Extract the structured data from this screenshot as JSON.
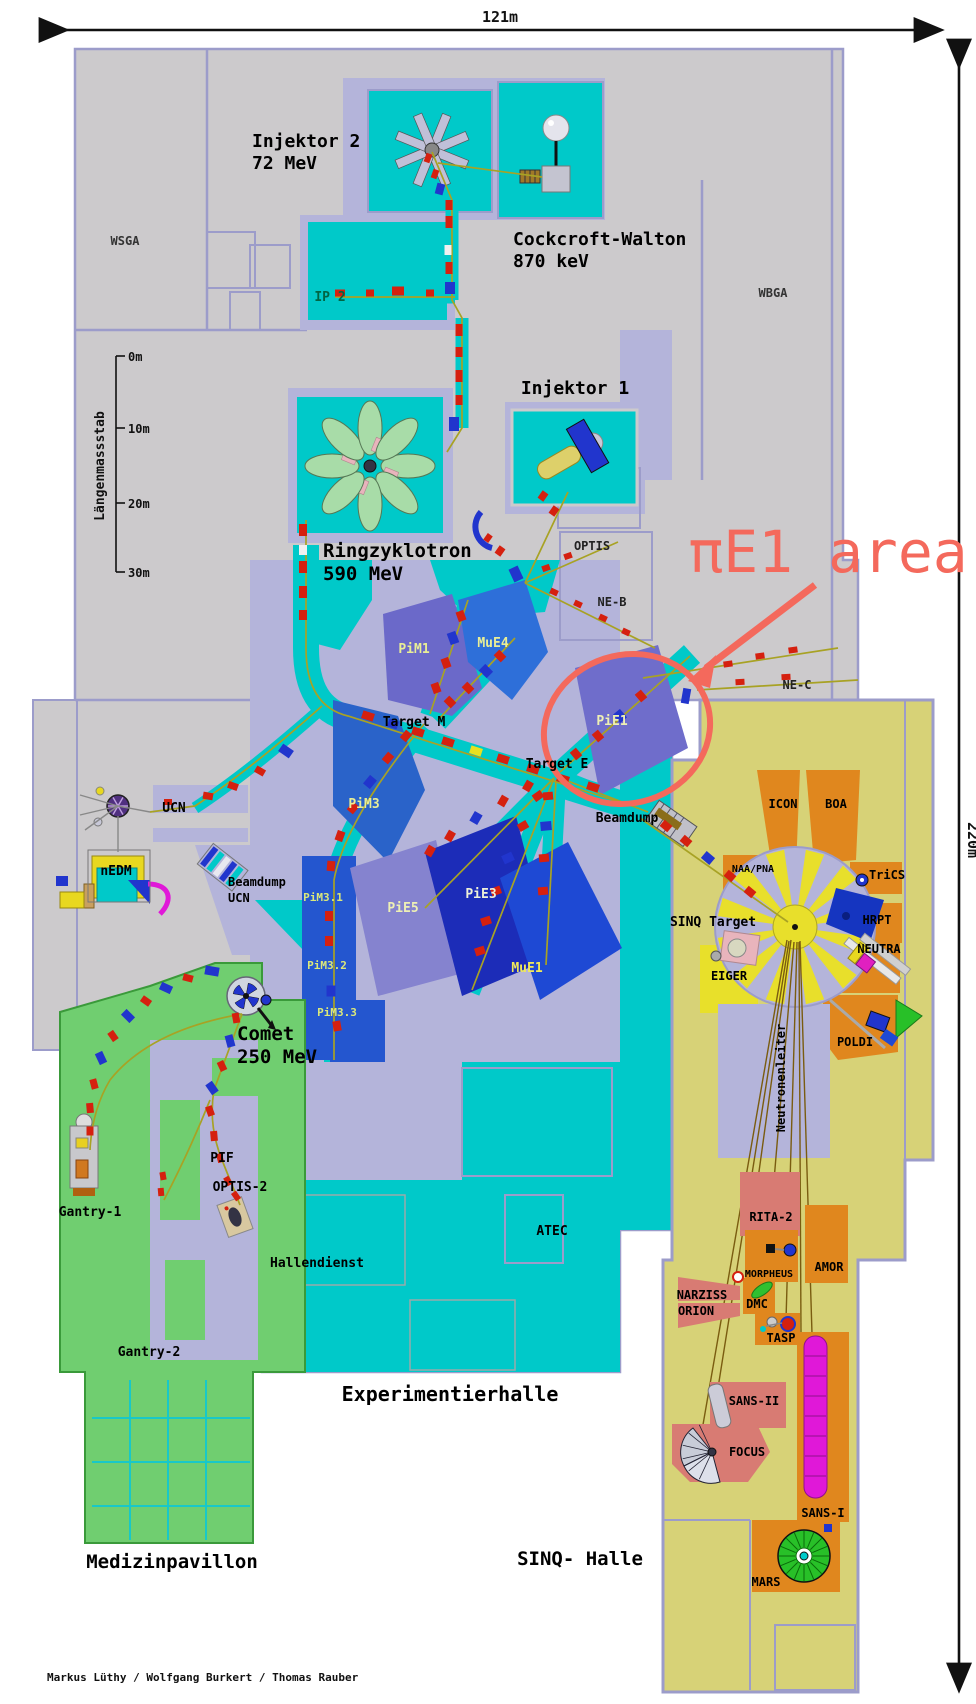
{
  "annotation": {
    "pie1_area_label": "πE1 area"
  },
  "dimensions": {
    "width_label": "121m",
    "height_label": "220m"
  },
  "scalebar": {
    "title": "Längenmassstab",
    "ticks": [
      "0m",
      "10m",
      "20m",
      "30m"
    ]
  },
  "labels": {
    "injektor2_1": "Injektor 2",
    "injektor2_2": "72 MeV",
    "cockcroft_1": "Cockcroft-Walton",
    "cockcroft_2": "870 keV",
    "wsga": "WSGA",
    "wbga": "WBGA",
    "ip2": "IP 2",
    "injektor1": "Injektor 1",
    "ring_1": "Ringzyklotron",
    "ring_2": "590 MeV",
    "optis": "OPTIS",
    "neb": "NE-B",
    "nec": "NE-C",
    "pim1": "PiM1",
    "mue4": "MuE4",
    "pie1": "PiE1",
    "target_m": "Target M",
    "target_e": "Target E",
    "beamdump": "Beamdump",
    "ucn": "UCN",
    "nedm": "nEDM",
    "bd_ucn1": "Beamdump",
    "bd_ucn2": "UCN",
    "pim3": "PiM3",
    "pim3_1": "PiM3.1",
    "pim3_2": "PiM3.2",
    "pim3_3": "PiM3.3",
    "pie5": "PiE5",
    "pie3": "PiE3",
    "mue1": "MuE1",
    "comet_1": "Comet",
    "comet_2": "250 MeV",
    "pif": "PIF",
    "optis2": "OPTIS-2",
    "gantry1": "Gantry-1",
    "gantry2": "Gantry-2",
    "hallendienst": "Hallendienst",
    "atec": "ATEC",
    "experimentierhalle": "Experimentierhalle",
    "medizinpavillon": "Medizinpavillon",
    "sinq_halle": "SINQ- Halle",
    "sinq_target": "SINQ Target",
    "icon": "ICON",
    "boa": "BOA",
    "naapna": "NAA/PNA",
    "trics": "TriCS",
    "hrpt": "HRPT",
    "neutra": "NEUTRA",
    "eiger": "EIGER",
    "poldi": "POLDI",
    "neutronenleiter": "Neutronenleiter",
    "rita2": "RITA-2",
    "amor": "AMOR",
    "morpheus": "MORPHEUS",
    "narziss": "NARZISS",
    "orion": "ORION",
    "dmc": "DMC",
    "tasp": "TASP",
    "sans2": "SANS-II",
    "focus": "FOCUS",
    "sans1": "SANS-I",
    "mars": "MARS"
  },
  "credit": "Markus Lüthy / Wolfgang Burkert / Thomas Rauber",
  "colors": {
    "building_gray": "#cccacc",
    "shield_lavender": "#b4b4da",
    "wall": "#9c9cca",
    "hall_cyan": "#00c9c9",
    "sinq_hall_yellow": "#d7d277",
    "instrument_orange": "#e0871e",
    "instrument_salmon": "#d87b73",
    "medical_green": "#70ce70",
    "eiger_yellow": "#e8e02a",
    "annotation_red": "#f4695c",
    "beamline_yellow": "#a8a224",
    "magnet_red": "#d5200f",
    "magnet_blue": "#2135cd",
    "area_pim1": "#6b69c9",
    "area_mue4": "#2e6fd9",
    "area_pie1": "#6f6dcb",
    "area_pim3": "#2a63c9",
    "area_pie5": "#8583cf",
    "area_pie3": "#1c2cb8",
    "area_mue1": "#1e49d4",
    "label_beam_yellow": "#e9ee96",
    "sans1_magenta": "#e018d8",
    "mars_green": "#28c028"
  }
}
